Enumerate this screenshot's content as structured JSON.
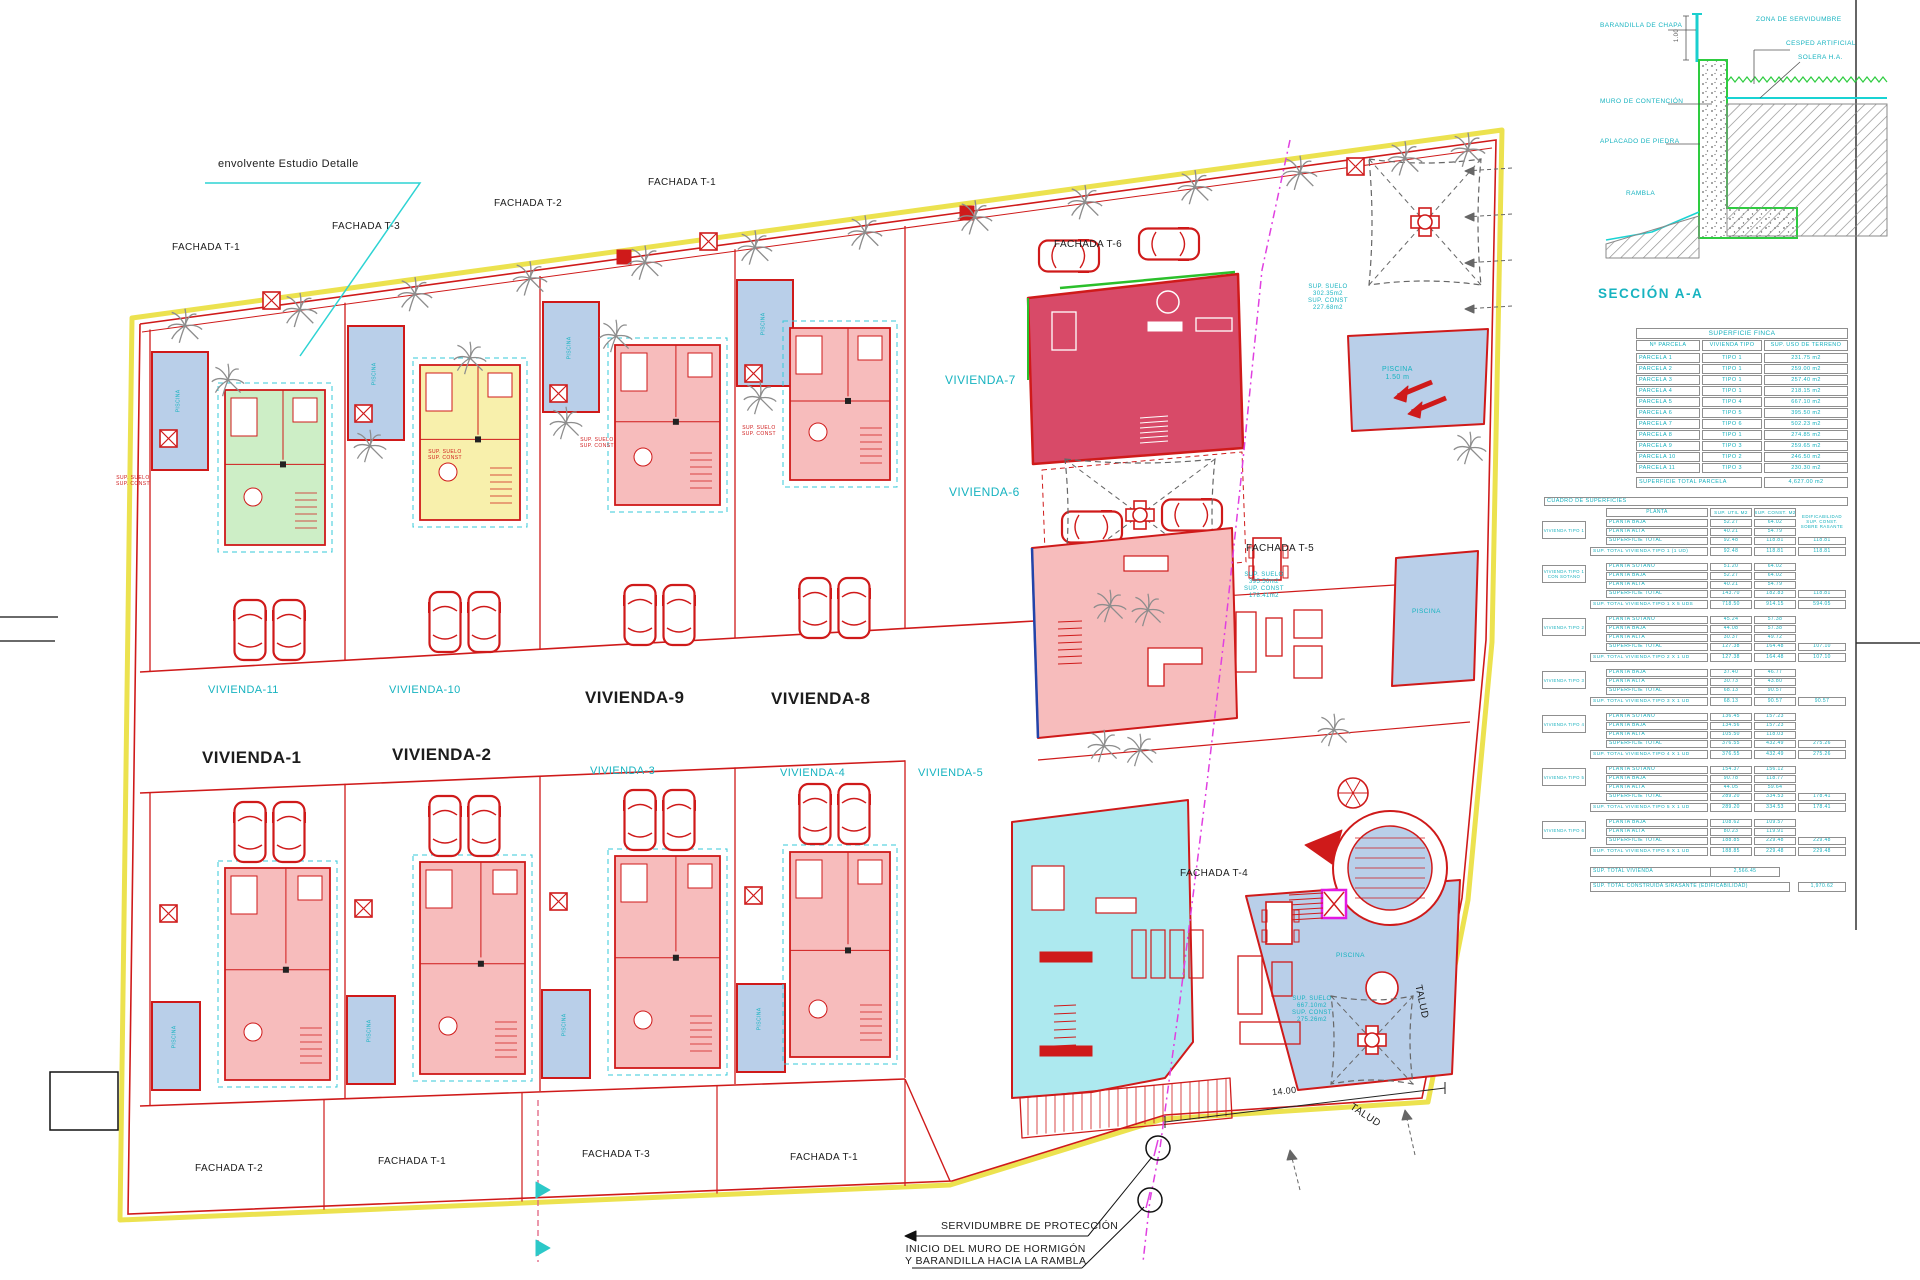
{
  "colors": {
    "boundary_yellow": "#ece24f",
    "line_red": "#cf1a1a",
    "accent_cyan": "#17b3c0",
    "pool_blue": "#b9cfe9",
    "pink": "#f7bcbc",
    "crimson": "#d84a68",
    "green": "#cdeec6",
    "pale_yellow": "#f8f0ac",
    "unit_cyan": "#ade9ef",
    "magenta": "#e318e3"
  },
  "plan": {
    "envolvente_label": "envolvente Estudio Detalle",
    "fachadas_top": [
      "FACHADA T-1",
      "FACHADA T-3",
      "FACHADA T-2",
      "FACHADA T-1",
      "FACHADA T-6"
    ],
    "fachadas_right": [
      "FACHADA T-5",
      "FACHADA T-4"
    ],
    "fachadas_bottom": [
      "FACHADA T-2",
      "FACHADA T-1",
      "FACHADA T-3",
      "FACHADA T-1"
    ],
    "viviendas_top": [
      "VIVIENDA-11",
      "VIVIENDA-10",
      "VIVIENDA-9",
      "VIVIENDA-8"
    ],
    "viviendas_bottom": [
      "VIVIENDA-1",
      "VIVIENDA-2",
      "VIVIENDA-3",
      "VIVIENDA-4",
      "VIVIENDA-5"
    ],
    "viviendas_right": [
      "VIVIENDA-7",
      "VIVIENDA-6"
    ],
    "talud": "TALUD",
    "dim_14": "14.00",
    "servidumbre": "SERVIDUMBRE DE PROTECCIÓN",
    "muro_note": "INICIO DEL MURO DE HORMIGÓN\nY BARANDILLA HACIA LA RAMBLA",
    "piscina_top": "PISCINA\n1.50 m",
    "piscina_label": "PISCINA",
    "sup_note_t6": "SUP. SUELO\n302.35m2\nSUP. CONST\n227.68m2",
    "sup_note_t5": "SUP. SUELO\n395.50m2\nSUP. CONST\n178.41m2",
    "sup_note_t4": "SUP. SUELO\n667.10m2\nSUP. CONST\n275.26m2",
    "sup_note_small": "SUP. SUELO\nSUP. CONST"
  },
  "seccion": {
    "title": "SECCIÓN A-A",
    "labels_left": [
      "BARANDILLA DE CHAPA",
      "MURO DE CONTENCIÓN",
      "APLACADO DE PIEDRA",
      "RAMBLA"
    ],
    "labels_right": [
      "ZONA DE SERVIDUMBRE",
      "CESPED ARTIFICIAL",
      "SOLERA H.A."
    ],
    "dim": "1.00"
  },
  "finca_table": {
    "title": "SUPERFICIE FINCA",
    "columns": [
      "Nº PARCELA",
      "VIVIENDA TIPO",
      "SUP. USO DE TERRENO"
    ],
    "rows": [
      [
        "PARCELA 1",
        "TIPO 1",
        "231.75 m2"
      ],
      [
        "PARCELA 2",
        "TIPO 1",
        "259.00 m2"
      ],
      [
        "PARCELA 3",
        "TIPO 1",
        "257.40 m2"
      ],
      [
        "PARCELA 4",
        "TIPO 1",
        "218.15 m2"
      ],
      [
        "PARCELA 5",
        "TIPO 4",
        "667.10 m2"
      ],
      [
        "PARCELA 6",
        "TIPO 5",
        "395.50 m2"
      ],
      [
        "PARCELA 7",
        "TIPO 6",
        "502.23 m2"
      ],
      [
        "PARCELA 8",
        "TIPO 1",
        "274.85 m2"
      ],
      [
        "PARCELA 9",
        "TIPO 3",
        "259.65 m2"
      ],
      [
        "PARCELA 10",
        "TIPO 2",
        "246.50 m2"
      ],
      [
        "PARCELA 11",
        "TIPO 3",
        "230.30 m2"
      ]
    ],
    "total_label": "SUPERFICIE TOTAL PARCELA",
    "total_value": "4,627.00 m2"
  },
  "cuadro_table": {
    "title": "CUADRO DE SUPERFICIES",
    "columns": [
      "PLANTA",
      "SUP. UTIL M2",
      "SUP. CONST. M2"
    ],
    "side_note": "EDIFICABILIDAD\nSUP. CONST.\nSOBRE RASANTE",
    "blocks": [
      {
        "label": "VIVIENDA TIPO 1",
        "rows": [
          [
            "PLANTA BAJA",
            "52.27",
            "64.02",
            ""
          ],
          [
            "PLANTA ALTA",
            "40.21",
            "54.79",
            ""
          ],
          [
            "SUPERFICIE TOTAL",
            "92.48",
            "118.81",
            "118.81"
          ]
        ],
        "total": [
          "SUP. TOTAL VIVIENDA TIPO 1 (1 UD)",
          "92.48",
          "118.81",
          "118.81"
        ]
      },
      {
        "label": "VIVIENDA TIPO 1 CON SOTANO",
        "rows": [
          [
            "PLANTA SOTANO",
            "51.20",
            "64.02",
            ""
          ],
          [
            "PLANTA BAJA",
            "52.27",
            "64.02",
            ""
          ],
          [
            "PLANTA ALTA",
            "40.21",
            "54.79",
            ""
          ],
          [
            "SUPERFICIE TOTAL",
            "143.70",
            "182.83",
            "118.81"
          ]
        ],
        "total": [
          "SUP. TOTAL VIVIENDA TIPO 1 X 5 UDS",
          "718.50",
          "914.15",
          "594.05"
        ]
      },
      {
        "label": "VIVIENDA TIPO 2",
        "rows": [
          [
            "PLANTA SOTANO",
            "45.24",
            "57.38",
            ""
          ],
          [
            "PLANTA BAJA",
            "44.08",
            "57.38",
            ""
          ],
          [
            "PLANTA ALTA",
            "30.37",
            "49.72",
            ""
          ],
          [
            "SUPERFICIE TOTAL",
            "127.38",
            "164.48",
            "107.10"
          ]
        ],
        "total": [
          "SUP. TOTAL VIVIENDA TIPO 2 X 1 UD",
          "127.38",
          "164.48",
          "107.10"
        ]
      },
      {
        "label": "VIVIENDA TIPO 3",
        "rows": [
          [
            "PLANTA BAJA",
            "37.40",
            "46.77",
            ""
          ],
          [
            "PLANTA ALTA",
            "30.73",
            "43.80",
            ""
          ],
          [
            "SUPERFICIE TOTAL",
            "68.13",
            "90.57",
            ""
          ]
        ],
        "total": [
          "SUP. TOTAL VIVIENDA TIPO 3 X 1 UD",
          "68.13",
          "90.57",
          "90.57"
        ]
      },
      {
        "label": "VIVIENDA TIPO 4",
        "rows": [
          [
            "PLANTA SOTANO",
            "136.45",
            "157.23",
            ""
          ],
          [
            "PLANTA BAJA",
            "134.56",
            "157.23",
            ""
          ],
          [
            "PLANTA ALTA",
            "105.50",
            "118.03",
            ""
          ],
          [
            "SUPERFICIE TOTAL",
            "376.55",
            "432.49",
            "275.26"
          ]
        ],
        "total": [
          "SUP. TOTAL VIVIENDA TIPO 4 X 1 UD",
          "376.55",
          "432.49",
          "275.26"
        ]
      },
      {
        "label": "VIVIENDA TIPO 5",
        "rows": [
          [
            "PLANTA SOTANO",
            "154.37",
            "156.12",
            ""
          ],
          [
            "PLANTA BAJA",
            "90.78",
            "118.77",
            ""
          ],
          [
            "PLANTA ALTA",
            "44.05",
            "59.64",
            ""
          ],
          [
            "SUPERFICIE TOTAL",
            "289.20",
            "334.53",
            "178.41"
          ]
        ],
        "total": [
          "SUP. TOTAL VIVIENDA TIPO 5 X 1 UD",
          "289.20",
          "334.53",
          "178.41"
        ]
      },
      {
        "label": "VIVIENDA TIPO 6",
        "rows": [
          [
            "PLANTA BAJA",
            "108.62",
            "109.57",
            ""
          ],
          [
            "PLANTA ALTA",
            "80.23",
            "119.91",
            ""
          ],
          [
            "SUPERFICIE TOTAL",
            "188.85",
            "229.48",
            "229.48"
          ]
        ],
        "total": [
          "SUP. TOTAL VIVIENDA TIPO 6 X 1 UD",
          "188.85",
          "229.48",
          "229.48"
        ]
      }
    ],
    "summary": [
      [
        "SUP. TOTAL VIVIENDA",
        "2,566.45"
      ],
      [
        "SUP. TOTAL CONSTRUIDA S/RASANTE (EDIFICABILIDAD)",
        "1,970.62"
      ]
    ]
  }
}
